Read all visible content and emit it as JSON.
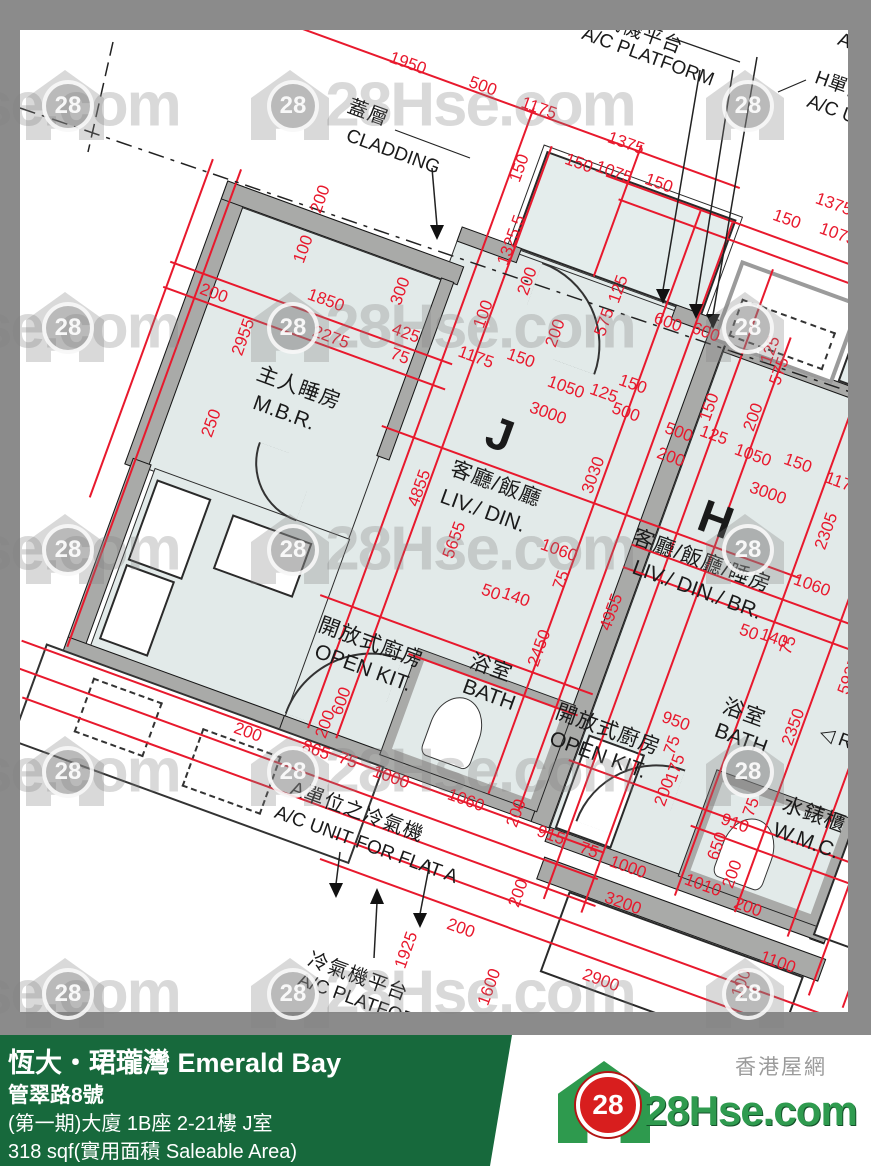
{
  "palette": {
    "dim_red": "#e8192d",
    "room_fill": "#e2eae9",
    "wall_gray": "#a9aaa8",
    "frame_gray": "#8b8b8b",
    "footer_green": "#17693c",
    "logo_green": "#2f9b4f",
    "logo_red": "#d81e1e"
  },
  "watermark": {
    "text": "28Hse.com",
    "logo_number": "28",
    "rows_y": [
      105,
      327,
      549,
      771,
      993
    ],
    "text_x": [
      25,
      480
    ],
    "icon_x": [
      65,
      290,
      745
    ]
  },
  "footer": {
    "title": "恆大・珺瓏灣 Emerald Bay",
    "address": "管翠路8號",
    "unit": "(第一期)大廈 1B座 2-21樓 J室",
    "area": "318 sqf(實用面積 Saleable Area)"
  },
  "logo": {
    "number": "28",
    "name": "28Hse.com",
    "tagline": "香港屋網"
  },
  "plan": {
    "labels": [
      {
        "t": "冷氣機平台",
        "x": 633,
        "y": 30,
        "r": 20,
        "c": "zh2"
      },
      {
        "t": "A/C PLATFORM",
        "x": 648,
        "y": 57,
        "r": 20,
        "c": "en2"
      },
      {
        "t": "蓋層",
        "x": 368,
        "y": 113,
        "r": 20,
        "c": "zh2"
      },
      {
        "t": "CLADDING",
        "x": 393,
        "y": 152,
        "r": 20,
        "c": "en2"
      },
      {
        "t": "H單位",
        "x": 840,
        "y": 86,
        "r": 20,
        "c": "en2"
      },
      {
        "t": "A/C UN",
        "x": 838,
        "y": 112,
        "r": 20,
        "c": "en2"
      },
      {
        "t": "A/",
        "x": 847,
        "y": 42,
        "r": 20,
        "c": "en2"
      },
      {
        "t": "1950",
        "x": 408,
        "y": 63,
        "r": 20,
        "c": "dim"
      },
      {
        "t": "500",
        "x": 483,
        "y": 86,
        "r": 20,
        "c": "dim"
      },
      {
        "t": "1175",
        "x": 539,
        "y": 108,
        "r": 20,
        "c": "dim"
      },
      {
        "t": "1375",
        "x": 626,
        "y": 143,
        "r": 20,
        "c": "dim"
      },
      {
        "t": "150",
        "x": 519,
        "y": 168,
        "r": -70,
        "c": "dim"
      },
      {
        "t": "150",
        "x": 579,
        "y": 163,
        "r": 20,
        "c": "dim"
      },
      {
        "t": "1075",
        "x": 614,
        "y": 172,
        "r": 20,
        "c": "dim"
      },
      {
        "t": "150",
        "x": 659,
        "y": 183,
        "r": 20,
        "c": "dim"
      },
      {
        "t": "1375",
        "x": 834,
        "y": 204,
        "r": 20,
        "c": "dim"
      },
      {
        "t": "150",
        "x": 787,
        "y": 219,
        "r": 20,
        "c": "dim"
      },
      {
        "t": "1075",
        "x": 838,
        "y": 234,
        "r": 20,
        "c": "dim"
      },
      {
        "t": "200",
        "x": 320,
        "y": 199,
        "r": -70,
        "c": "dim"
      },
      {
        "t": "100",
        "x": 303,
        "y": 249,
        "r": -70,
        "c": "dim"
      },
      {
        "t": "1850",
        "x": 326,
        "y": 300,
        "r": 20,
        "c": "dim"
      },
      {
        "t": "2275",
        "x": 331,
        "y": 337,
        "r": 20,
        "c": "dim"
      },
      {
        "t": "425",
        "x": 406,
        "y": 333,
        "r": 20,
        "c": "dim"
      },
      {
        "t": "75",
        "x": 400,
        "y": 356,
        "r": 20,
        "c": "dim"
      },
      {
        "t": "300",
        "x": 400,
        "y": 291,
        "r": -70,
        "c": "dim"
      },
      {
        "t": "200",
        "x": 214,
        "y": 293,
        "r": 20,
        "c": "dim"
      },
      {
        "t": "2955",
        "x": 243,
        "y": 337,
        "r": -70,
        "c": "dim"
      },
      {
        "t": "250",
        "x": 211,
        "y": 423,
        "r": -70,
        "c": "dim"
      },
      {
        "t": "1325.5",
        "x": 511,
        "y": 240,
        "r": -70,
        "c": "dim"
      },
      {
        "t": "200",
        "x": 527,
        "y": 281,
        "r": -70,
        "c": "dim"
      },
      {
        "t": "100",
        "x": 483,
        "y": 314,
        "r": -70,
        "c": "dim"
      },
      {
        "t": "200",
        "x": 555,
        "y": 333,
        "r": -70,
        "c": "dim"
      },
      {
        "t": "125",
        "x": 618,
        "y": 289,
        "r": -70,
        "c": "dim"
      },
      {
        "t": "575",
        "x": 604,
        "y": 322,
        "r": -70,
        "c": "dim"
      },
      {
        "t": "600",
        "x": 668,
        "y": 322,
        "r": 20,
        "c": "dim"
      },
      {
        "t": "600",
        "x": 706,
        "y": 332,
        "r": 20,
        "c": "dim"
      },
      {
        "t": "125",
        "x": 770,
        "y": 350,
        "r": -70,
        "c": "dim"
      },
      {
        "t": "575",
        "x": 779,
        "y": 371,
        "r": -70,
        "c": "dim"
      },
      {
        "t": "1175",
        "x": 476,
        "y": 357,
        "r": 20,
        "c": "dim"
      },
      {
        "t": "150",
        "x": 521,
        "y": 358,
        "r": 20,
        "c": "dim"
      },
      {
        "t": "1050",
        "x": 566,
        "y": 387,
        "r": 20,
        "c": "dim"
      },
      {
        "t": "125",
        "x": 604,
        "y": 393,
        "r": 20,
        "c": "dim"
      },
      {
        "t": "3000",
        "x": 548,
        "y": 413,
        "r": 20,
        "c": "dim"
      },
      {
        "t": "150",
        "x": 633,
        "y": 384,
        "r": 20,
        "c": "dim"
      },
      {
        "t": "500",
        "x": 626,
        "y": 412,
        "r": 20,
        "c": "dim"
      },
      {
        "t": "500",
        "x": 679,
        "y": 432,
        "r": 20,
        "c": "dim"
      },
      {
        "t": "125",
        "x": 714,
        "y": 435,
        "r": 20,
        "c": "dim"
      },
      {
        "t": "150",
        "x": 709,
        "y": 407,
        "r": -70,
        "c": "dim"
      },
      {
        "t": "200",
        "x": 671,
        "y": 457,
        "r": 20,
        "c": "dim"
      },
      {
        "t": "200",
        "x": 753,
        "y": 417,
        "r": -70,
        "c": "dim"
      },
      {
        "t": "1050",
        "x": 753,
        "y": 455,
        "r": 20,
        "c": "dim"
      },
      {
        "t": "150",
        "x": 798,
        "y": 463,
        "r": 20,
        "c": "dim"
      },
      {
        "t": "3000",
        "x": 768,
        "y": 493,
        "r": 20,
        "c": "dim"
      },
      {
        "t": "1175",
        "x": 843,
        "y": 483,
        "r": 20,
        "c": "dim"
      },
      {
        "t": "4855",
        "x": 419,
        "y": 488,
        "r": -70,
        "c": "dim"
      },
      {
        "t": "5655",
        "x": 454,
        "y": 540,
        "r": -70,
        "c": "dim"
      },
      {
        "t": "3030",
        "x": 593,
        "y": 475,
        "r": -70,
        "c": "dim"
      },
      {
        "t": "4955",
        "x": 611,
        "y": 612,
        "r": -70,
        "c": "dim"
      },
      {
        "t": "1060",
        "x": 559,
        "y": 550,
        "r": 20,
        "c": "dim"
      },
      {
        "t": "50",
        "x": 491,
        "y": 592,
        "r": 20,
        "c": "dim"
      },
      {
        "t": "140",
        "x": 516,
        "y": 597,
        "r": 20,
        "c": "dim"
      },
      {
        "t": "75",
        "x": 561,
        "y": 580,
        "r": -70,
        "c": "dim"
      },
      {
        "t": "2450",
        "x": 539,
        "y": 648,
        "r": -70,
        "c": "dim"
      },
      {
        "t": "2305",
        "x": 826,
        "y": 531,
        "r": -70,
        "c": "dim"
      },
      {
        "t": "1060",
        "x": 812,
        "y": 585,
        "r": 20,
        "c": "dim"
      },
      {
        "t": "50",
        "x": 749,
        "y": 632,
        "r": 20,
        "c": "dim"
      },
      {
        "t": "140",
        "x": 774,
        "y": 638,
        "r": 20,
        "c": "dim"
      },
      {
        "t": "75",
        "x": 788,
        "y": 645,
        "r": -70,
        "c": "dim"
      },
      {
        "t": "5925",
        "x": 849,
        "y": 676,
        "r": -70,
        "c": "dim"
      },
      {
        "t": "950",
        "x": 676,
        "y": 721,
        "r": 20,
        "c": "dim"
      },
      {
        "t": "75",
        "x": 672,
        "y": 745,
        "r": -70,
        "c": "dim"
      },
      {
        "t": "175",
        "x": 675,
        "y": 768,
        "r": -70,
        "c": "dim"
      },
      {
        "t": "200",
        "x": 664,
        "y": 792,
        "r": -70,
        "c": "dim"
      },
      {
        "t": "2350",
        "x": 793,
        "y": 727,
        "r": -70,
        "c": "dim"
      },
      {
        "t": "910",
        "x": 735,
        "y": 823,
        "r": 20,
        "c": "dim"
      },
      {
        "t": "650",
        "x": 717,
        "y": 846,
        "r": -70,
        "c": "dim"
      },
      {
        "t": "75",
        "x": 751,
        "y": 807,
        "r": -70,
        "c": "dim"
      },
      {
        "t": "200",
        "x": 732,
        "y": 874,
        "r": -70,
        "c": "dim"
      },
      {
        "t": "600",
        "x": 341,
        "y": 701,
        "r": -70,
        "c": "dim"
      },
      {
        "t": "200",
        "x": 325,
        "y": 724,
        "r": -70,
        "c": "dim"
      },
      {
        "t": "200",
        "x": 248,
        "y": 732,
        "r": 20,
        "c": "dim"
      },
      {
        "t": "865",
        "x": 316,
        "y": 750,
        "r": 20,
        "c": "dim"
      },
      {
        "t": "75",
        "x": 348,
        "y": 760,
        "r": 20,
        "c": "dim"
      },
      {
        "t": "1000",
        "x": 391,
        "y": 777,
        "r": 20,
        "c": "dim"
      },
      {
        "t": "1060",
        "x": 466,
        "y": 800,
        "r": 20,
        "c": "dim"
      },
      {
        "t": "200",
        "x": 516,
        "y": 813,
        "r": -70,
        "c": "dim"
      },
      {
        "t": "915",
        "x": 551,
        "y": 835,
        "r": 20,
        "c": "dim"
      },
      {
        "t": "75",
        "x": 589,
        "y": 850,
        "r": 20,
        "c": "dim"
      },
      {
        "t": "1000",
        "x": 628,
        "y": 867,
        "r": 20,
        "c": "dim"
      },
      {
        "t": "1010",
        "x": 703,
        "y": 885,
        "r": 20,
        "c": "dim"
      },
      {
        "t": "200",
        "x": 748,
        "y": 907,
        "r": 20,
        "c": "dim"
      },
      {
        "t": "3200",
        "x": 623,
        "y": 903,
        "r": 20,
        "c": "dim"
      },
      {
        "t": "200",
        "x": 518,
        "y": 893,
        "r": -70,
        "c": "dim"
      },
      {
        "t": "200",
        "x": 461,
        "y": 928,
        "r": 20,
        "c": "dim"
      },
      {
        "t": "2900",
        "x": 601,
        "y": 980,
        "r": 20,
        "c": "dim"
      },
      {
        "t": "1100",
        "x": 778,
        "y": 962,
        "r": 20,
        "c": "dim"
      },
      {
        "t": "100",
        "x": 741,
        "y": 983,
        "r": -70,
        "c": "dim"
      },
      {
        "t": "1600",
        "x": 489,
        "y": 987,
        "r": -70,
        "c": "dim"
      },
      {
        "t": "1925",
        "x": 406,
        "y": 950,
        "r": -70,
        "c": "dim"
      },
      {
        "t": "主人睡房",
        "x": 299,
        "y": 388,
        "r": 20,
        "c": "zh"
      },
      {
        "t": "M.B.R.",
        "x": 284,
        "y": 413,
        "r": 20,
        "c": "en"
      },
      {
        "t": "J",
        "x": 500,
        "y": 434,
        "r": 20,
        "c": "big"
      },
      {
        "t": "客廳/飯廳",
        "x": 496,
        "y": 484,
        "r": 20,
        "c": "zh"
      },
      {
        "t": "LIV./ DIN.",
        "x": 483,
        "y": 511,
        "r": 20,
        "c": "en"
      },
      {
        "t": "H",
        "x": 716,
        "y": 519,
        "r": 20,
        "c": "big"
      },
      {
        "t": "客廳/飯廳/睡房",
        "x": 702,
        "y": 561,
        "r": 20,
        "c": "zh"
      },
      {
        "t": "LIV./ DIN./ BR.",
        "x": 697,
        "y": 590,
        "r": 20,
        "c": "en"
      },
      {
        "t": "開放式廚房",
        "x": 371,
        "y": 643,
        "r": 20,
        "c": "zh"
      },
      {
        "t": "OPEN KIT.",
        "x": 363,
        "y": 668,
        "r": 20,
        "c": "en"
      },
      {
        "t": "浴室",
        "x": 491,
        "y": 668,
        "r": 20,
        "c": "zh"
      },
      {
        "t": "BATH",
        "x": 489,
        "y": 695,
        "r": 20,
        "c": "en"
      },
      {
        "t": "開放式廚房",
        "x": 608,
        "y": 730,
        "r": 20,
        "c": "zh"
      },
      {
        "t": "OPEN KIT.",
        "x": 598,
        "y": 755,
        "r": 20,
        "c": "en"
      },
      {
        "t": "浴室",
        "x": 744,
        "y": 713,
        "r": 20,
        "c": "zh"
      },
      {
        "t": "BATH",
        "x": 741,
        "y": 739,
        "r": 20,
        "c": "en"
      },
      {
        "t": "水錶櫃",
        "x": 814,
        "y": 815,
        "r": 20,
        "c": "zh"
      },
      {
        "t": "W.M.C.",
        "x": 806,
        "y": 841,
        "r": 20,
        "c": "en"
      },
      {
        "t": "◁ R",
        "x": 836,
        "y": 738,
        "r": 20,
        "c": "en2"
      },
      {
        "t": "A單位之冷氣機",
        "x": 357,
        "y": 812,
        "r": 20,
        "c": "zh2"
      },
      {
        "t": "A/C UNIT FOR FLAT A",
        "x": 366,
        "y": 845,
        "r": 20,
        "c": "en2"
      },
      {
        "t": "冷氣機平台",
        "x": 358,
        "y": 977,
        "r": 20,
        "c": "zh2"
      },
      {
        "t": "A/C PLATFORM",
        "x": 364,
        "y": 1003,
        "r": 20,
        "c": "en2"
      }
    ]
  }
}
